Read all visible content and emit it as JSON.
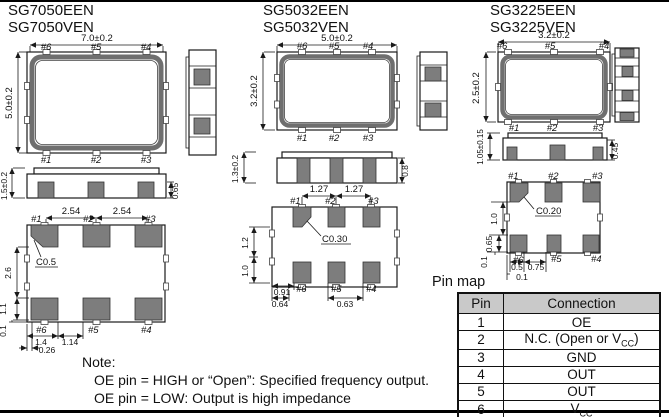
{
  "packages": [
    {
      "titles": [
        "SG7050EEN",
        "SG7050VEN"
      ],
      "top_view": {
        "width_dim": "7.0±0.2",
        "height_dim": "5.0±0.2",
        "pads_top": [
          "#6",
          "#5",
          "#4"
        ],
        "pads_bottom": [
          "#1",
          "#2",
          "#3"
        ]
      },
      "side_view": {
        "height_dim": "1.5±0.2",
        "pad_dim": "0.65"
      },
      "bottom_view": {
        "pads_top": [
          "#1",
          "#2",
          "#3"
        ],
        "pads_bottom": [
          "#6",
          "#5",
          "#4"
        ],
        "pitch_dims": [
          "2.54",
          "2.54"
        ],
        "chamfer": "C0.5",
        "left_dims": [
          "2.6",
          "1.1",
          "0.1"
        ],
        "bottom_dims": [
          "1.4",
          "1.14",
          "0.26"
        ]
      }
    },
    {
      "titles": [
        "SG5032EEN",
        "SG5032VEN"
      ],
      "top_view": {
        "width_dim": "5.0±0.2",
        "height_dim": "3.2±0.2",
        "pads_top": [
          "#6",
          "#5",
          "#4"
        ],
        "pads_bottom": [
          "#1",
          "#2",
          "#3"
        ]
      },
      "side_view": {
        "height_dim": "1.3±0.2",
        "pad_dim": "0.8"
      },
      "bottom_view": {
        "pads_top": [
          "#1",
          "#2",
          "#3"
        ],
        "pads_bottom": [
          "#6",
          "#5",
          "#4"
        ],
        "pitch_dims": [
          "1.27",
          "1.27"
        ],
        "chamfer": "C0.30",
        "left_dims": [
          "1.2",
          "1.0"
        ],
        "bottom_dims": [
          "0.91",
          "0.64",
          "0.63"
        ]
      }
    },
    {
      "titles": [
        "SG3225EEN",
        "SG3225VEN"
      ],
      "top_view": {
        "width_dim": "3.2±0.2",
        "height_dim": "2.5±0.2",
        "pads_top": [
          "#6",
          "#5",
          "#4"
        ],
        "pads_bottom": [
          "#1",
          "#2",
          "#3"
        ]
      },
      "side_view": {
        "height_dim": "1.05±0.15",
        "pad_dim": "0.45"
      },
      "bottom_view": {
        "pads_top": [
          "#1",
          "#2",
          "#3"
        ],
        "pads_bottom": [
          "#6",
          "#5",
          "#4"
        ],
        "chamfer": "C0.20",
        "left_dims": [
          "1.0",
          "0.65",
          "0.1"
        ],
        "bottom_dims": [
          "0.5",
          "0.75",
          "0.1"
        ]
      }
    }
  ],
  "pin_map": {
    "title": "Pin map",
    "headers": [
      "Pin",
      "Connection"
    ],
    "rows": [
      {
        "pin": "1",
        "connection": "OE"
      },
      {
        "pin": "2",
        "connection_pre": "N.C. (Open or V",
        "connection_sub": "CC",
        "connection_post": ")"
      },
      {
        "pin": "3",
        "connection": "GND"
      },
      {
        "pin": "4",
        "connection": "OUT"
      },
      {
        "pin": "5",
        "connection": "OUT",
        "overline": true
      },
      {
        "pin": "6",
        "connection_pre": "V",
        "connection_sub": "CC"
      }
    ]
  },
  "note": {
    "heading": "Note:",
    "lines": [
      "OE pin = HIGH or “Open”: Specified frequency output.",
      "OE pin = LOW: Output is high impedance"
    ]
  },
  "colors": {
    "pad_gray": "#7d7d7d",
    "ring_gray": "#6f6f6f",
    "table_header_gray": "#c9c9c9",
    "line_black": "#1a1a1a"
  }
}
